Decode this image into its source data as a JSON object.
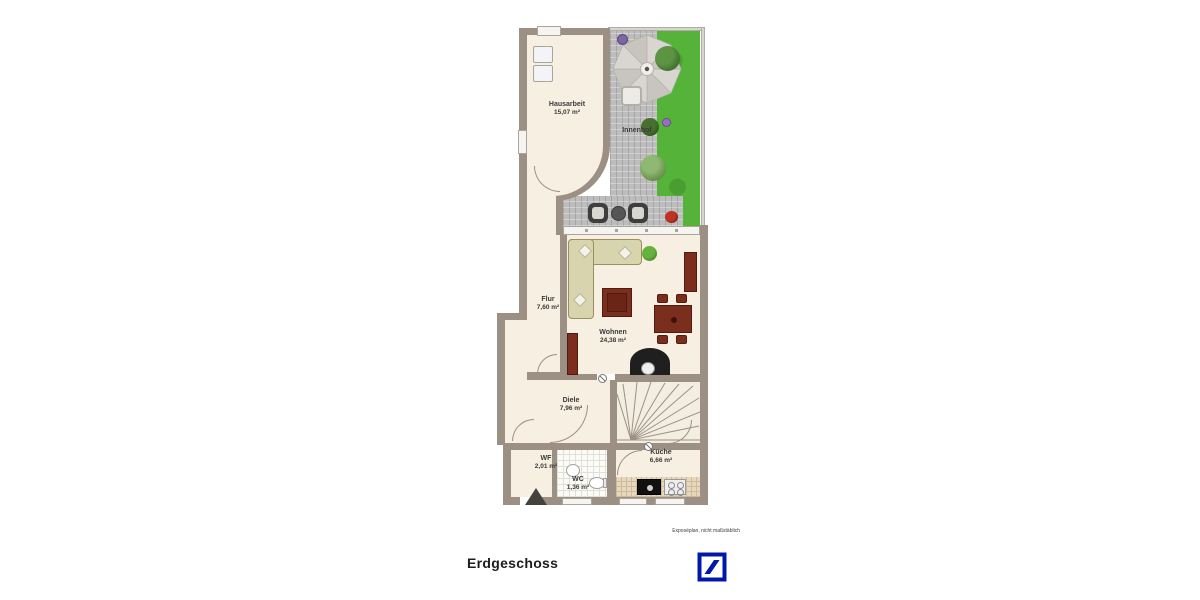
{
  "plan": {
    "floor_title": "Erdgeschoss",
    "disclaimer": "Exposéplan, nicht maßstäblich",
    "rooms": {
      "hausarbeit": {
        "name": "Hausarbeit",
        "area": "15,07 m²"
      },
      "innenhof": {
        "name": "Innenhof",
        "area": ""
      },
      "flur": {
        "name": "Flur",
        "area": "7,60 m²"
      },
      "wohnen": {
        "name": "Wohnen",
        "area": "24,38 m²"
      },
      "diele": {
        "name": "Diele",
        "area": "7,96 m²"
      },
      "wf": {
        "name": "WF",
        "area": "2,01 m²"
      },
      "wc": {
        "name": "WC",
        "area": "1,36 m²"
      },
      "kueche": {
        "name": "Küche",
        "area": "6,66 m²"
      }
    }
  },
  "brand": {
    "logo_name": "deutsche-bank",
    "color": "#0018A8"
  },
  "colors": {
    "wall": "#9c9084",
    "floor": "#f8efe3",
    "grass": "#56b33a",
    "paving": "#bdbdbd",
    "furniture_red": "#7c2e1e"
  }
}
